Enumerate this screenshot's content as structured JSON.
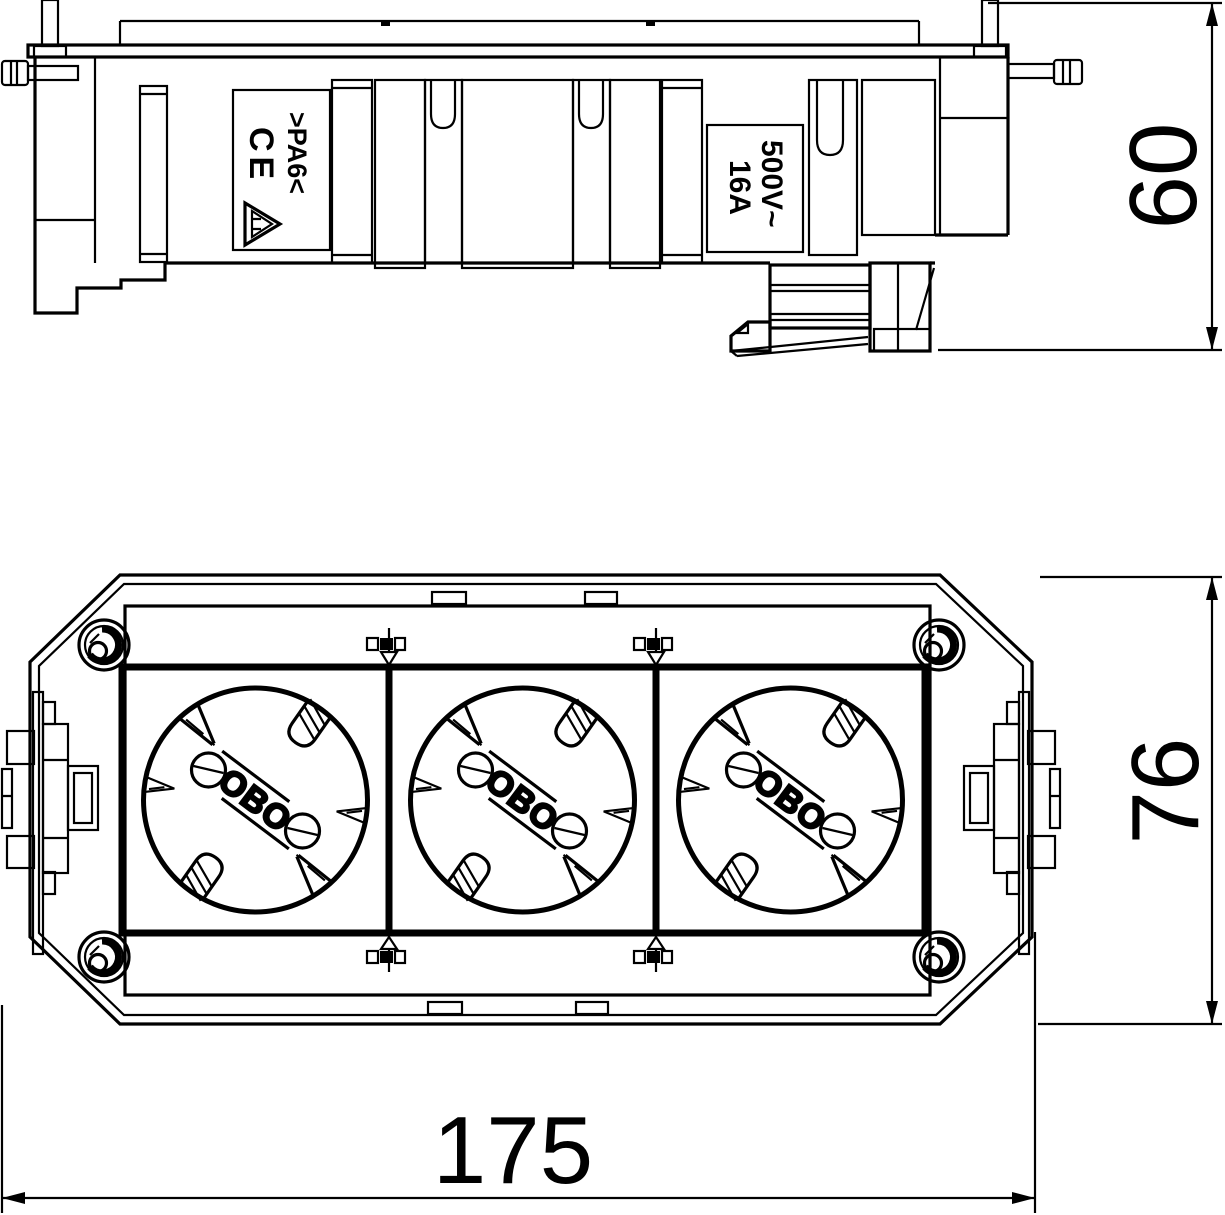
{
  "colors": {
    "ink": "#000000",
    "paper": "#ffffff"
  },
  "side_view": {
    "approval_plate": {
      "ce": "CE",
      "material": ">PA6<",
      "vde_icon": "vde-triangle-icon"
    },
    "rating_plate": {
      "voltage": "500V~",
      "current": "16A"
    }
  },
  "front_view": {
    "socket_count": "3",
    "logo": "OBO"
  },
  "dimensions": {
    "height_mm": "60",
    "depth_mm": "76",
    "length_mm": "175"
  }
}
